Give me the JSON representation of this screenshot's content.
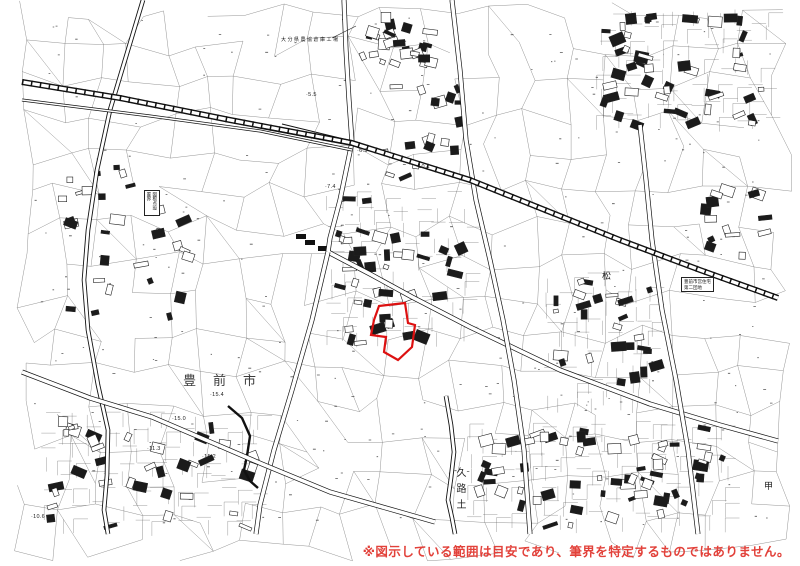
{
  "map": {
    "disclaimer": "※図示している範囲は目安であり、筆界を特定するものではありません。",
    "colors": {
      "disclaimer": "#e2413a",
      "highlight": "#dd1111",
      "linework": "#111111"
    },
    "highlight": {
      "points": [
        [
          379,
          306
        ],
        [
          405,
          303
        ],
        [
          408,
          323
        ],
        [
          415,
          325
        ],
        [
          412,
          347
        ],
        [
          398,
          360
        ],
        [
          384,
          352
        ],
        [
          386,
          337
        ],
        [
          371,
          335
        ],
        [
          374,
          320
        ]
      ]
    },
    "labels": {
      "city": {
        "text": "豊前市",
        "x": 183,
        "y": 370
      },
      "district": {
        "text": "久路土",
        "x": 452,
        "y": 467
      },
      "matsu": {
        "text": "松",
        "x": 602,
        "y": 269
      },
      "kou": {
        "text": "甲",
        "x": 764,
        "y": 479
      }
    },
    "annotations": {
      "top": {
        "text": "大分県農協倉庫工場",
        "x": 281,
        "y": 36
      },
      "right_line1": "豊前市営住宅",
      "right_line2": "第二団地",
      "left_vertical": "図根点設置界"
    },
    "elevations": [
      {
        "text": "·5.5",
        "x": 306,
        "y": 92
      },
      {
        "text": "·6.3",
        "x": 357,
        "y": 148
      },
      {
        "text": "·7.4",
        "x": 325,
        "y": 184
      },
      {
        "text": "·10.1",
        "x": 416,
        "y": 164
      },
      {
        "text": "·15.4",
        "x": 210,
        "y": 392
      },
      {
        "text": "·15.0",
        "x": 172,
        "y": 416
      },
      {
        "text": "·15.2",
        "x": 202,
        "y": 454
      },
      {
        "text": "·11.3",
        "x": 147,
        "y": 446
      },
      {
        "text": "·10.6",
        "x": 31,
        "y": 514
      }
    ]
  }
}
